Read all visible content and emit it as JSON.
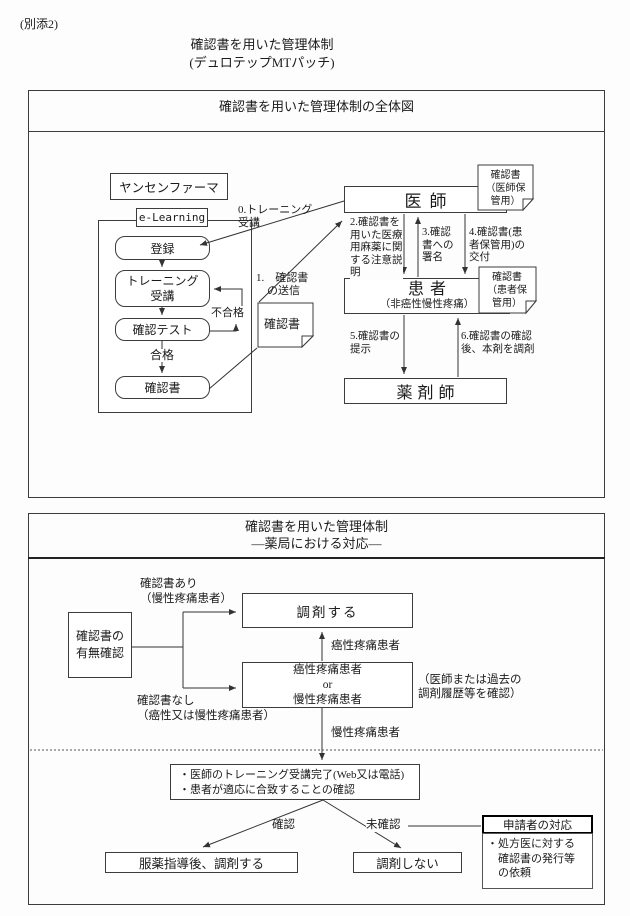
{
  "page": {
    "attachment_label": "(別添2)",
    "doc_title_line1": "確認書を用いた管理体制",
    "doc_title_line2": "(デュロテップMTパッチ)"
  },
  "overview_diagram": {
    "frame_title": "確認書を用いた管理体制の全体図",
    "janssen_label": "ヤンセンファーマ",
    "elearning_label": "e-Learning",
    "steps": {
      "register": "登録",
      "training": "トレーニング\n受講",
      "test": "確認テスト",
      "certificate": "確認書"
    },
    "pass_label": "合格",
    "fail_label": "不合格",
    "arrow_labels": {
      "step0": "0.トレーニング\n受講",
      "step1": "1.　確認書\n　の送信",
      "step2": "2.確認書を\n用いた医療\n用麻薬に関\nする注意説\n明",
      "step3": "3.確認\n書への\n署名",
      "step4": "4.確認書(患\n者保管用)の\n交付",
      "step5": "5.確認書の\n提示",
      "step6": "6.確認書の確認\n後、本剤を調剤"
    },
    "actors": {
      "doctor": "医師",
      "patient": "患者",
      "patient_sub": "（非癌性慢性疼痛）",
      "pharmacist": "薬剤師"
    },
    "notes": {
      "middle": "確認書",
      "doctor": "確認書\n（医師保\n管用）",
      "patient": "確認書\n（患者保\n管用）"
    }
  },
  "pharmacy_diagram": {
    "frame_title_line1": "確認書を用いた管理体制",
    "frame_title_line2": "―薬局における対応―",
    "check_box": "確認書の\n有無確認",
    "with_cert_label": "確認書あり\n（慢性疼痛患者）",
    "without_cert_label": "確認書なし\n（癌性又は慢性疼痛患者）",
    "dispense_box": "調剤する",
    "or_box": "癌性疼痛患者\nor\n慢性疼痛患者",
    "cancer_pain_label": "癌性疼痛患者",
    "chronic_pain_label": "慢性疼痛患者",
    "side_note": "（医師または過去の\n調剤履歴等を確認）",
    "confirm_box": "・医師のトレーニング受講完了(Web又は電話)\n・患者が適応に合致することの確認",
    "confirmed_label": "確認",
    "unconfirmed_label": "未確認",
    "guidance_box": "服薬指導後、調剤する",
    "no_dispense_box": "調剤しない",
    "applicant_box": {
      "header": "申請者の対応",
      "body": "・処方医に対する\n　確認書の発行等\n　の依頼"
    }
  }
}
